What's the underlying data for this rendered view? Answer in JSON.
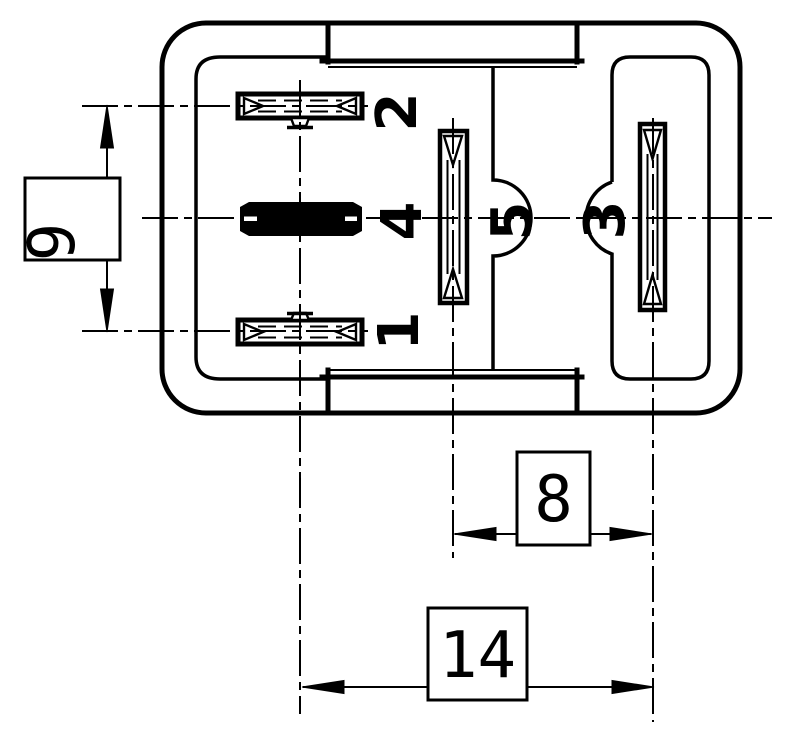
{
  "page": {
    "background_color": "#ffffff",
    "line_color": "#000000"
  },
  "diagram": {
    "kind": "technical-drawing",
    "subject": "relay-terminal-footprint-bottom-view",
    "pins": [
      {
        "id": "pin-1",
        "label": "1"
      },
      {
        "id": "pin-2",
        "label": "2"
      },
      {
        "id": "pin-3",
        "label": "3"
      },
      {
        "id": "pin-4",
        "label": "4"
      },
      {
        "id": "pin-5",
        "label": "5"
      }
    ],
    "dimensions": [
      {
        "id": "dim-vertical-pin-spacing",
        "label": "9",
        "orientation": "vertical"
      },
      {
        "id": "dim-pin5-pin3-spacing",
        "label": "8",
        "orientation": "horizontal"
      },
      {
        "id": "dim-overall-pin-spacing",
        "label": "14",
        "orientation": "horizontal"
      }
    ]
  }
}
